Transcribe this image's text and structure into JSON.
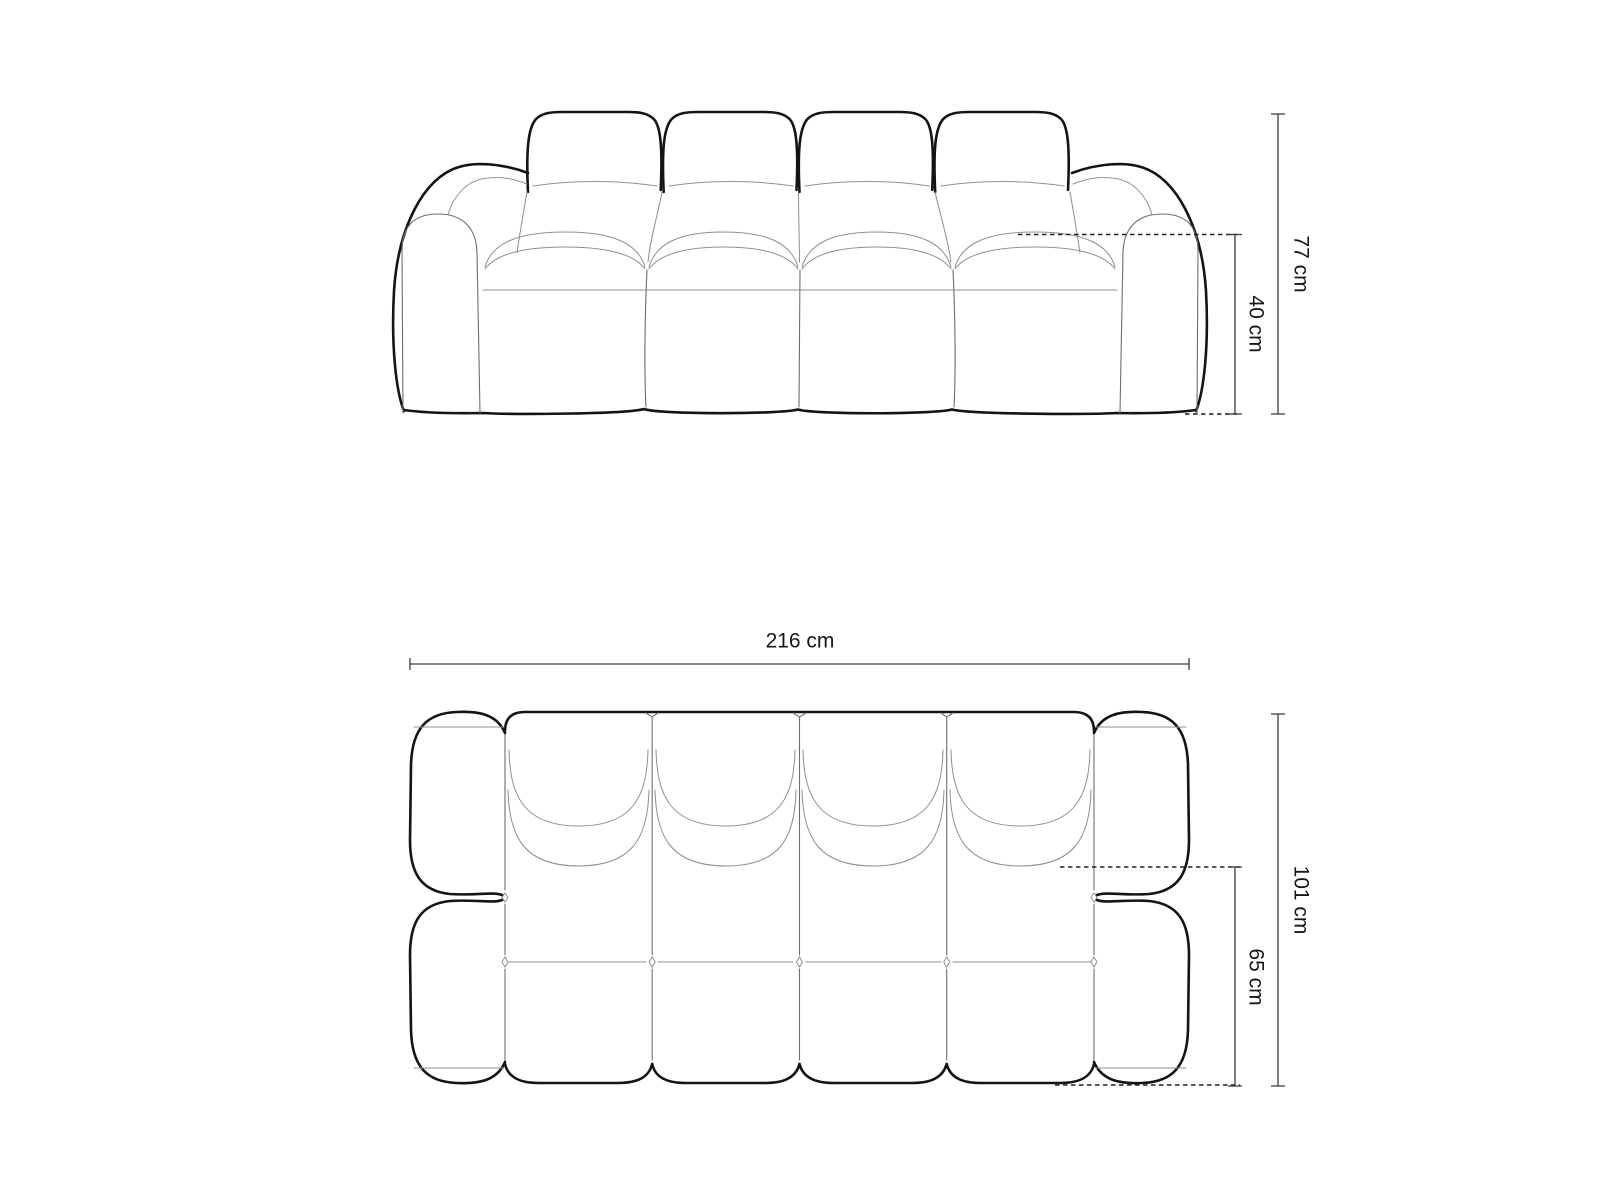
{
  "diagram": {
    "front_view": {
      "overall_height": "77 cm",
      "seat_height": "40 cm"
    },
    "top_view": {
      "overall_width": "216 cm",
      "overall_depth": "101 cm",
      "seat_depth": "65 cm"
    },
    "colors": {
      "background": "#ffffff",
      "outline": "#141414",
      "seam": "#8f8f8f",
      "dimension_line": "#3c3c3c",
      "label_text": "#161616"
    }
  }
}
